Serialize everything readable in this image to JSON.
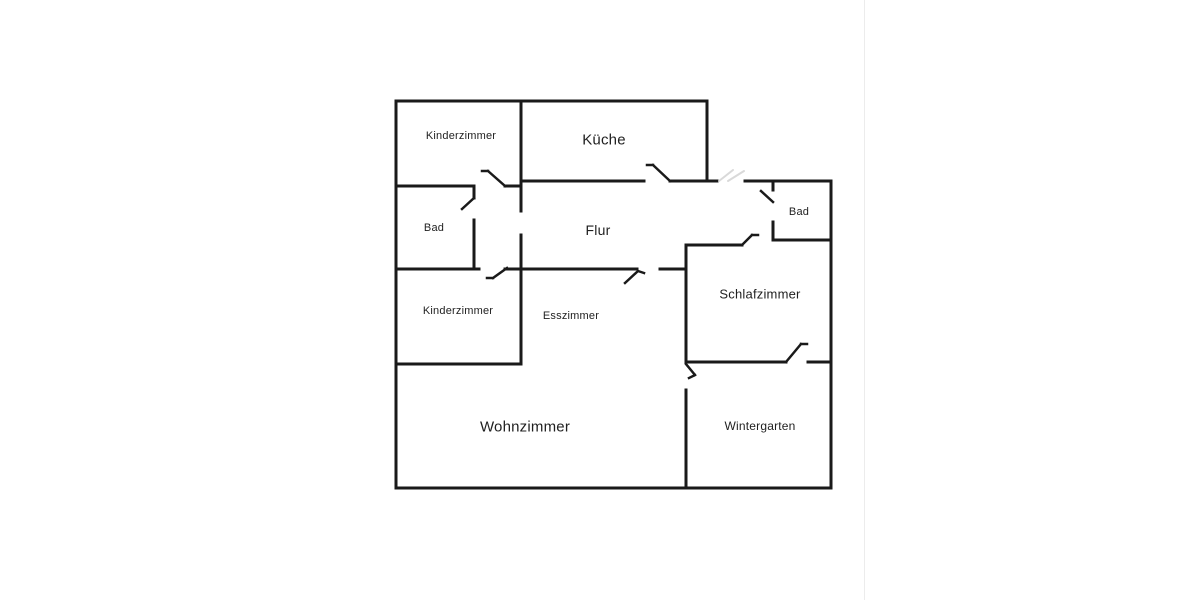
{
  "colors": {
    "background": "#ffffff",
    "walls": "#1a1a1a",
    "text": "#1f1f1f",
    "erased_artifact": "#d9d9d9",
    "page_divider": "#ececec"
  },
  "rooms": {
    "kinderzimmer_top": "Kinderzimmer",
    "kueche": "Küche",
    "bad_left": "Bad",
    "flur": "Flur",
    "kinderzimmer_left": "Kinderzimmer",
    "esszimmer": "Esszimmer",
    "schlafzimmer": "Schlafzimmer",
    "bad_right": "Bad",
    "wohnzimmer": "Wohnzimmer",
    "wintergarten": "Wintergarten"
  }
}
